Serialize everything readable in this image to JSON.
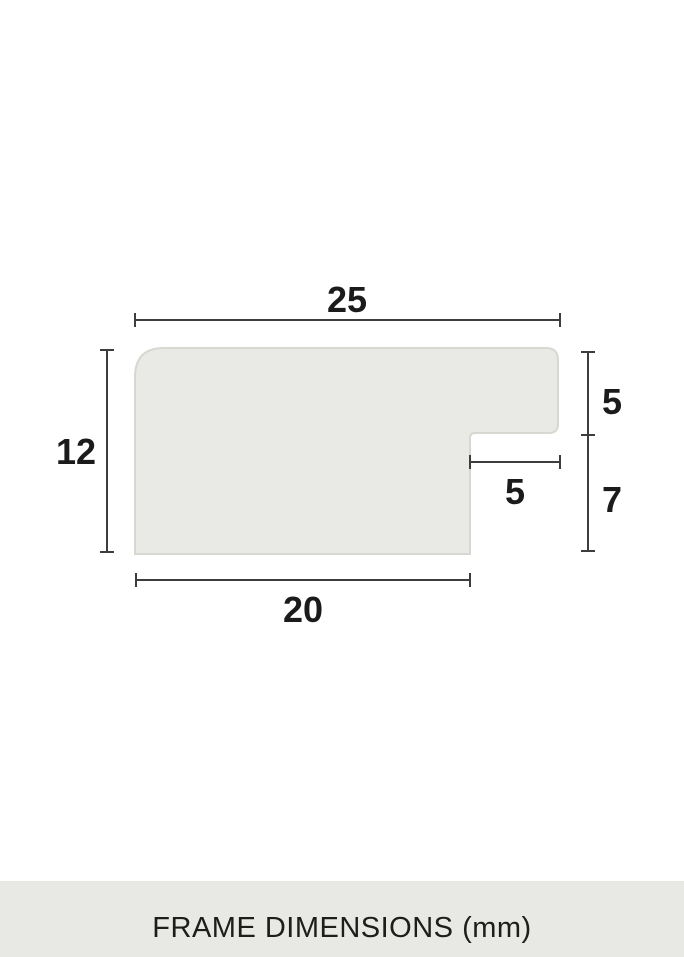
{
  "diagram": {
    "subject": "frame-moulding-cross-section-profile",
    "units": "mm",
    "dims": {
      "top_width": "25",
      "left_height": "12",
      "right_upper_height": "5",
      "notch_width": "5",
      "right_lower_height": "7",
      "bottom_width": "20"
    },
    "colors": {
      "profile_fill": "#e9eae5",
      "profile_stroke": "#d7d8d2",
      "dimension_line": "#3d3d3d",
      "label_text": "#1b1b1b"
    }
  },
  "footer": {
    "caption": "FRAME DIMENSIONS (mm)",
    "background": "#e8e9e4",
    "text_color": "#1d1d1b"
  }
}
